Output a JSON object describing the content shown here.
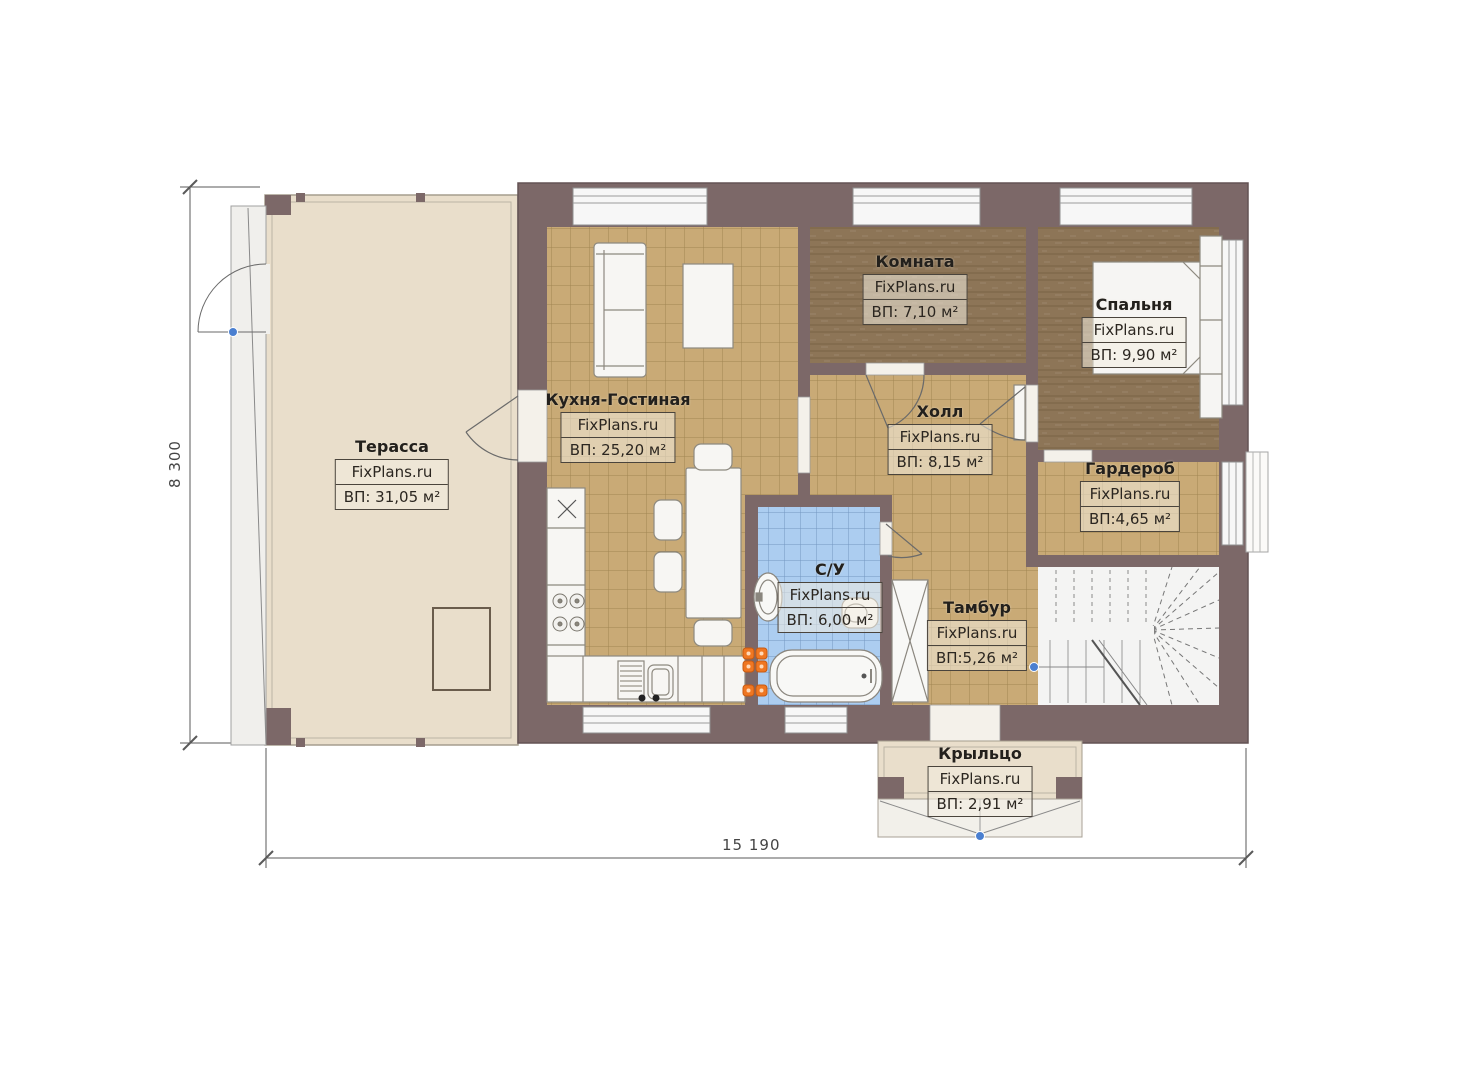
{
  "watermark": "FixPlans.ru",
  "dimensions": {
    "overall_width": "15 190",
    "overall_height": "8 300"
  },
  "rooms": {
    "terrace": {
      "name": "Терасса",
      "area": "ВП: 31,05 м²"
    },
    "kitchen": {
      "name": "Кухня-Гостиная",
      "area": "ВП: 25,20 м²"
    },
    "room": {
      "name": "Комната",
      "area": "ВП: 7,10 м²"
    },
    "bedroom": {
      "name": "Спальня",
      "area": "ВП: 9,90 м²"
    },
    "hall": {
      "name": "Холл",
      "area": "ВП: 8,15 м²"
    },
    "wardrobe": {
      "name": "Гардероб",
      "area": "ВП:4,65 м²"
    },
    "bathroom": {
      "name": "С/У",
      "area": "ВП: 6,00 м²"
    },
    "vestibule": {
      "name": "Тамбур",
      "area": "ВП:5,26 м²"
    },
    "porch": {
      "name": "Крыльцо",
      "area": "ВП: 2,91 м²"
    }
  },
  "colors": {
    "wall": "#7c6868",
    "tile_floor": "#c9aa76",
    "wood_floor": "#8d7557",
    "terrace_floor": "#e9decb",
    "bath_floor": "#accdf0",
    "radiator_orange": "#ef7722",
    "marker_blue": "#4a7fd0"
  }
}
